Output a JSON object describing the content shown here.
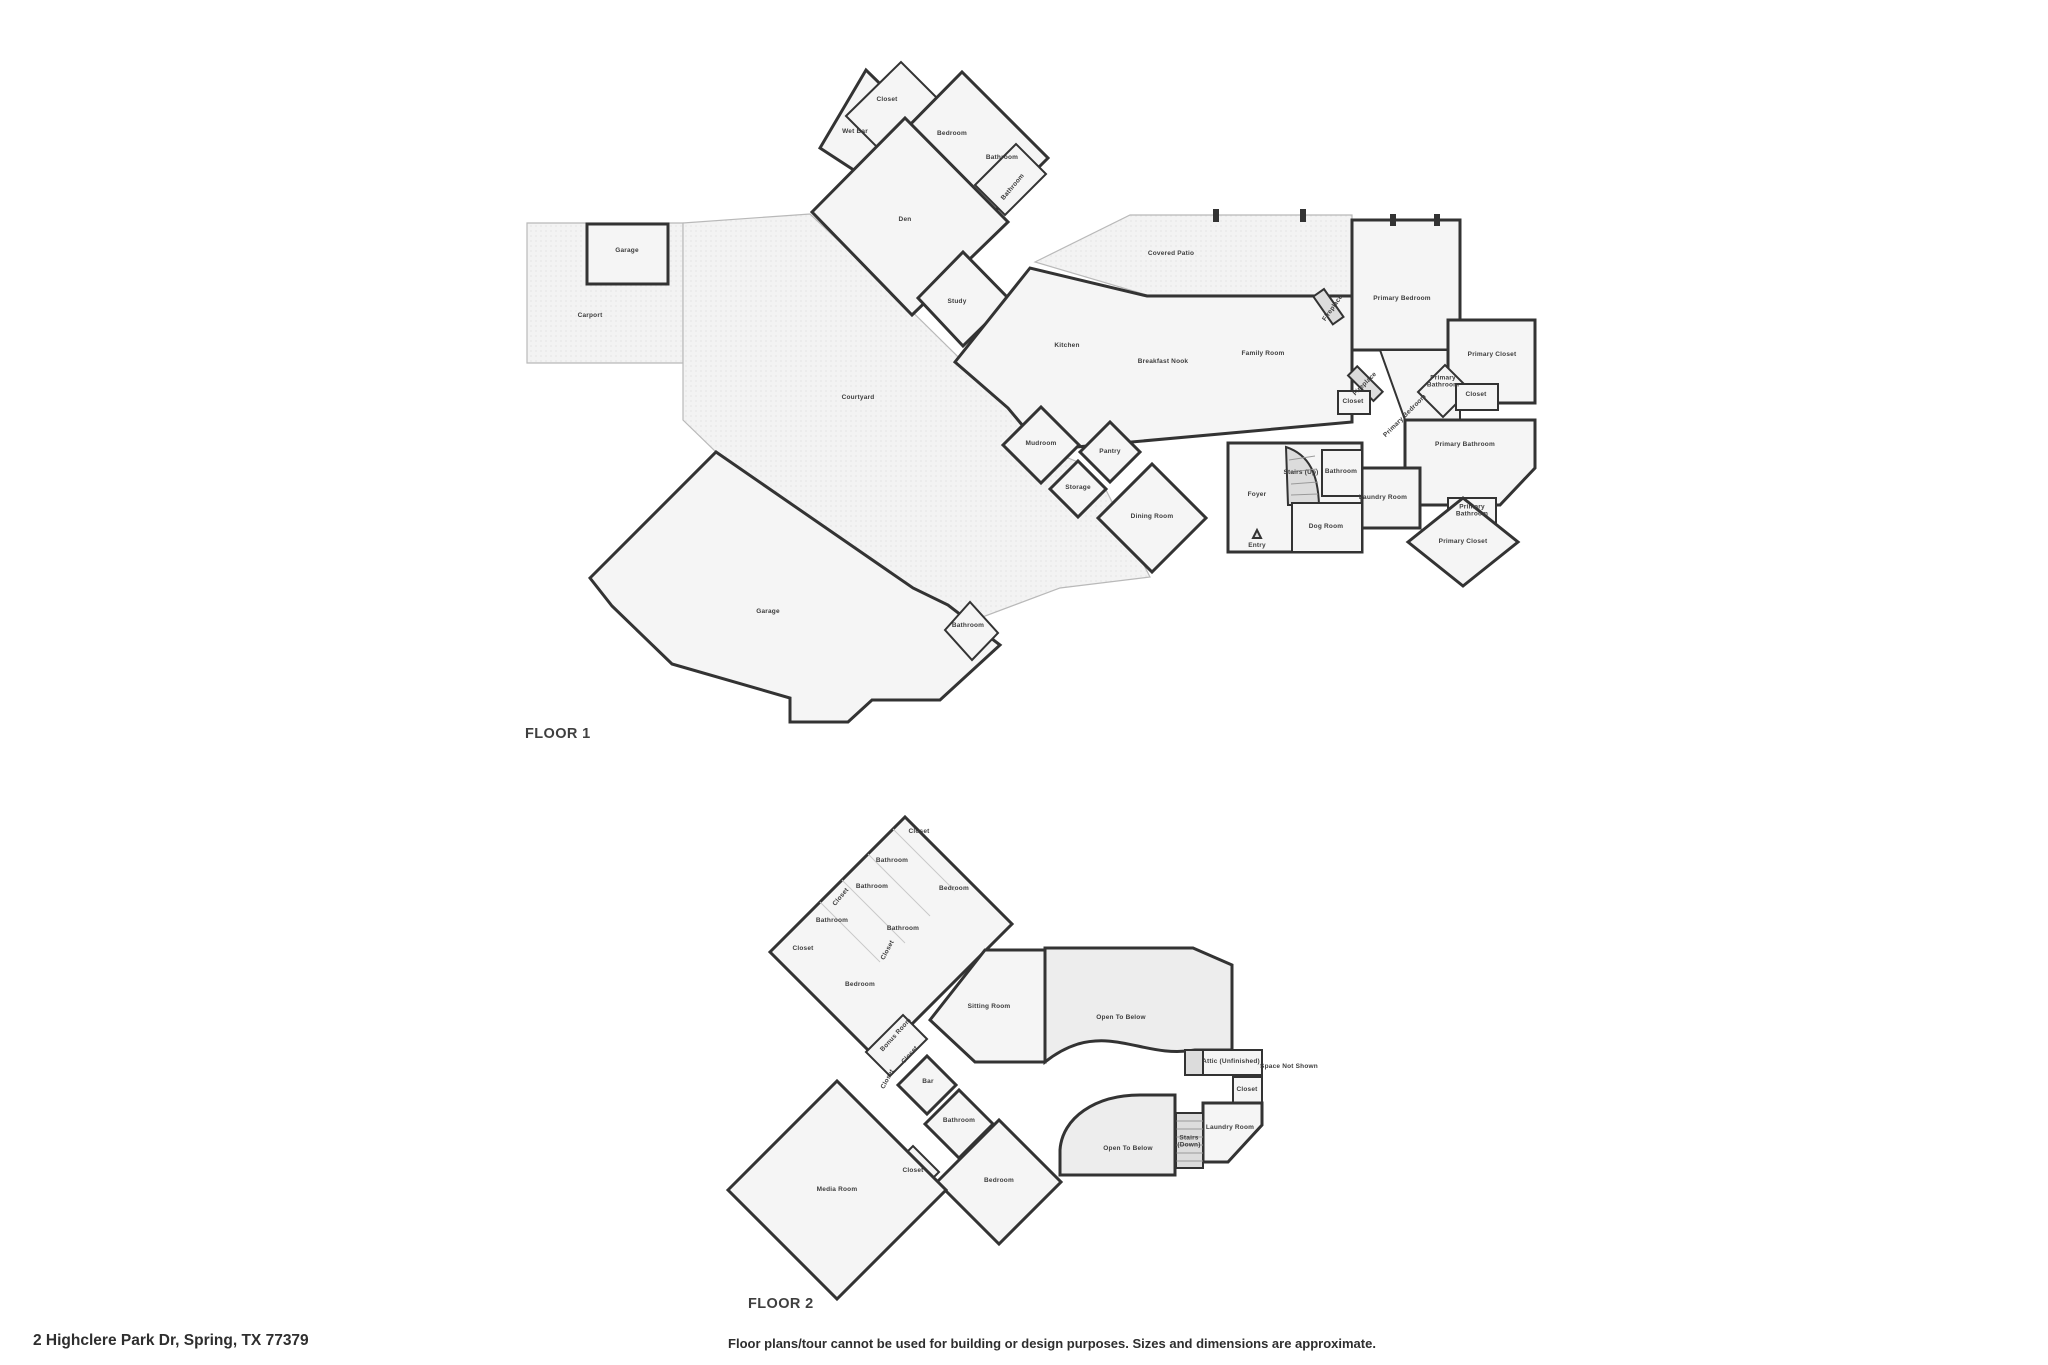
{
  "address": "2 Highclere Park Dr, Spring, TX 77379",
  "disclaimer": "Floor plans/tour cannot be used for building or design purposes. Sizes and dimensions are approximate.",
  "colors": {
    "wall": "#333333",
    "floor_fill": "#f5f5f5",
    "outdoor_dot": "#dddddd",
    "shaded_fill": "#dcdcdc",
    "label_text": "#3d3d3d",
    "title_text": "#3f3f3f"
  },
  "floors": [
    {
      "title": "FLOOR 1",
      "rooms": [
        {
          "label": "Closet",
          "x": 887,
          "y": 101
        },
        {
          "label": "Wet Bar",
          "x": 855,
          "y": 133
        },
        {
          "label": "Bedroom",
          "x": 952,
          "y": 135
        },
        {
          "label": "Bathroom",
          "x": 1002,
          "y": 159,
          "fs": 6
        },
        {
          "label": "Bathroom",
          "x": 1014,
          "y": 188,
          "rot": -50,
          "fs": 5
        },
        {
          "label": "Den",
          "x": 905,
          "y": 221
        },
        {
          "label": "Study",
          "x": 957,
          "y": 303
        },
        {
          "label": "Garage",
          "x": 627,
          "y": 252
        },
        {
          "label": "Carport",
          "x": 590,
          "y": 317
        },
        {
          "label": "Courtyard",
          "x": 858,
          "y": 399
        },
        {
          "label": "Kitchen",
          "x": 1067,
          "y": 347
        },
        {
          "label": "Breakfast Nook",
          "x": 1163,
          "y": 363
        },
        {
          "label": "Family Room",
          "x": 1263,
          "y": 355
        },
        {
          "label": "Covered Patio",
          "x": 1171,
          "y": 255
        },
        {
          "label": "Fireplace",
          "x": 1334,
          "y": 309,
          "rot": -55,
          "fs": 5
        },
        {
          "label": "Primary Bedroom",
          "x": 1402,
          "y": 300
        },
        {
          "label": "Closet",
          "x": 1353,
          "y": 403,
          "fs": 5.5
        },
        {
          "label": "Fireplace",
          "x": 1366,
          "y": 385,
          "rot": -45,
          "fs": 5
        },
        {
          "label": "Primary\nBathroom",
          "x": 1443,
          "y": 383,
          "fs": 5.5
        },
        {
          "label": "Closet",
          "x": 1476,
          "y": 396,
          "fs": 5.5
        },
        {
          "label": "Primary Closet",
          "x": 1492,
          "y": 356
        },
        {
          "label": "Primary Bedroom",
          "x": 1406,
          "y": 417,
          "rot": -45,
          "fs": 5
        },
        {
          "label": "Primary Bathroom",
          "x": 1465,
          "y": 446
        },
        {
          "label": "Laundry Room",
          "x": 1383,
          "y": 499,
          "fs": 6
        },
        {
          "label": "Primary\nBathroom",
          "x": 1472,
          "y": 512,
          "fs": 5.5
        },
        {
          "label": "Primary Closet",
          "x": 1463,
          "y": 543
        },
        {
          "label": "Mudroom",
          "x": 1041,
          "y": 445
        },
        {
          "label": "Pantry",
          "x": 1110,
          "y": 453
        },
        {
          "label": "Storage",
          "x": 1078,
          "y": 489
        },
        {
          "label": "Dining Room",
          "x": 1152,
          "y": 518
        },
        {
          "label": "Foyer",
          "x": 1257,
          "y": 496
        },
        {
          "label": "Stairs (Up)",
          "x": 1301,
          "y": 474,
          "fs": 5.2
        },
        {
          "label": "Bathroom",
          "x": 1341,
          "y": 473,
          "fs": 5.5
        },
        {
          "label": "Dog Room",
          "x": 1326,
          "y": 528
        },
        {
          "label": "Entry",
          "x": 1257,
          "y": 547,
          "fs": 6
        },
        {
          "label": "Bathroom",
          "x": 968,
          "y": 627,
          "fs": 6
        },
        {
          "label": "Garage",
          "x": 768,
          "y": 613
        }
      ]
    },
    {
      "title": "FLOOR 2",
      "rooms": [
        {
          "label": "Closet",
          "x": 919,
          "y": 833
        },
        {
          "label": "Bathroom",
          "x": 892,
          "y": 862,
          "fs": 6
        },
        {
          "label": "Bathroom",
          "x": 872,
          "y": 888,
          "fs": 6
        },
        {
          "label": "Closet",
          "x": 842,
          "y": 898,
          "rot": -50,
          "fs": 5
        },
        {
          "label": "Bathroom",
          "x": 832,
          "y": 922,
          "fs": 6
        },
        {
          "label": "Closet",
          "x": 803,
          "y": 950,
          "fs": 6
        },
        {
          "label": "Bedroom",
          "x": 860,
          "y": 986
        },
        {
          "label": "Bedroom",
          "x": 954,
          "y": 890
        },
        {
          "label": "Bathroom",
          "x": 903,
          "y": 930,
          "fs": 6
        },
        {
          "label": "Closet",
          "x": 889,
          "y": 951,
          "rot": -62,
          "fs": 5
        },
        {
          "label": "Sitting Room",
          "x": 989,
          "y": 1008
        },
        {
          "label": "Open To Below",
          "x": 1121,
          "y": 1019
        },
        {
          "label": "Attic (Unfinished)",
          "x": 1231,
          "y": 1063,
          "fs": 5.2
        },
        {
          "label": "Space Not Shown",
          "x": 1289,
          "y": 1068,
          "fs": 6
        },
        {
          "label": "Closet",
          "x": 1247,
          "y": 1091,
          "fs": 5.5
        },
        {
          "label": "Laundry Room",
          "x": 1230,
          "y": 1129,
          "fs": 6
        },
        {
          "label": "Stairs\n(Down)",
          "x": 1189,
          "y": 1143,
          "fs": 5.2
        },
        {
          "label": "Open To Below",
          "x": 1128,
          "y": 1150,
          "fs": 6
        },
        {
          "label": "Bonus Room",
          "x": 897,
          "y": 1036,
          "rot": -48,
          "fs": 5
        },
        {
          "label": "Closet",
          "x": 911,
          "y": 1056,
          "rot": -48,
          "fs": 5
        },
        {
          "label": "Closet",
          "x": 889,
          "y": 1080,
          "rot": -62,
          "fs": 5
        },
        {
          "label": "Bar",
          "x": 928,
          "y": 1083
        },
        {
          "label": "Bathroom",
          "x": 959,
          "y": 1122,
          "fs": 6
        },
        {
          "label": "Closet",
          "x": 913,
          "y": 1172,
          "fs": 6
        },
        {
          "label": "Media Room",
          "x": 837,
          "y": 1191
        },
        {
          "label": "Bedroom",
          "x": 999,
          "y": 1182
        }
      ]
    }
  ]
}
